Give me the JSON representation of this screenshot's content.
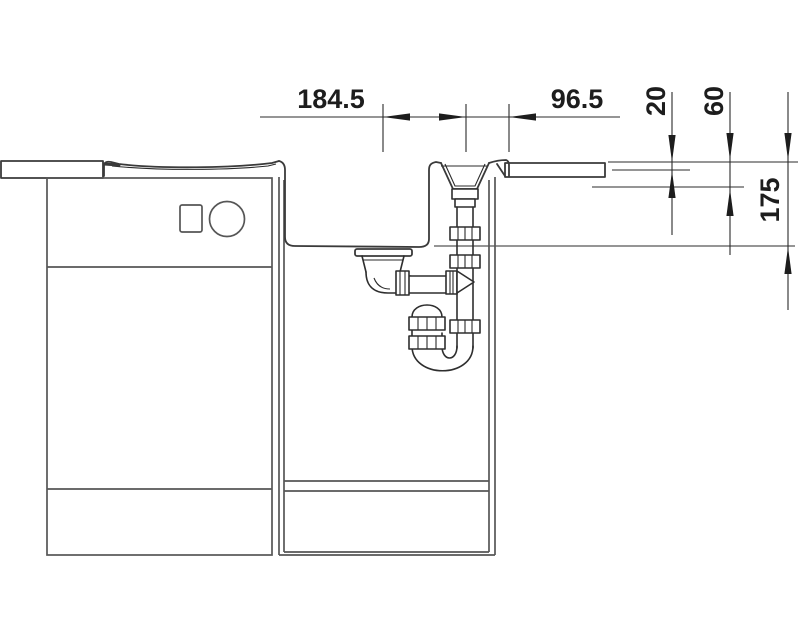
{
  "drawing": {
    "type": "technical-section-drawing",
    "subject": "kitchen sink and worktop installation with drain assembly",
    "background_color": "#ffffff",
    "line_color": "#3a3a3a",
    "dimension_color": "#1d1d1d"
  },
  "labels": {
    "dim_horizontal_1": "184.5",
    "dim_horizontal_2": "96.5",
    "dim_vertical_1": "20",
    "dim_vertical_2": "60",
    "dim_vertical_3": "175"
  }
}
